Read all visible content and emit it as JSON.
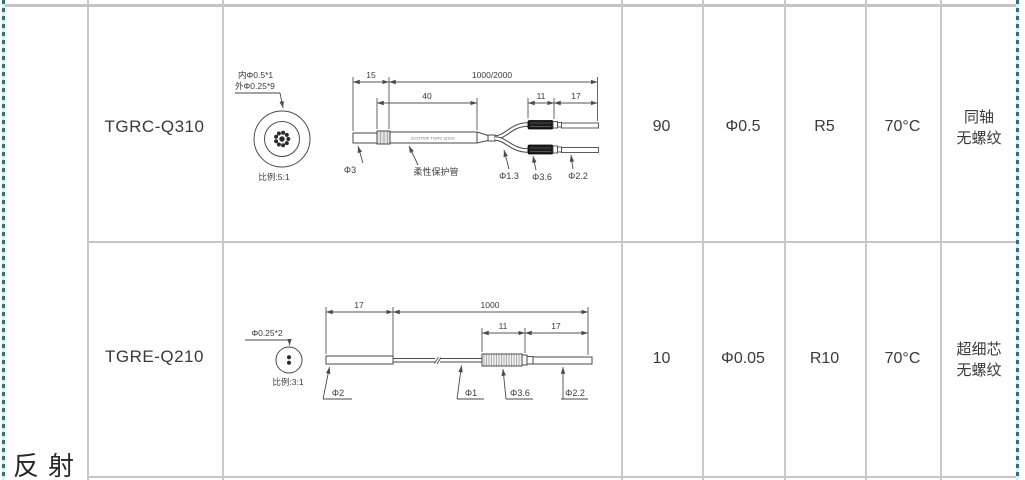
{
  "section": {
    "label": "反射"
  },
  "colors": {
    "marquee": "#2e6f80",
    "grid": "#c9c9c9",
    "ink": "#3c3c3c"
  },
  "rows": [
    {
      "model": "TGRC-Q310",
      "core_count": "90",
      "fiber_diameter": "Φ0.5",
      "bend_radius": "R5",
      "temperature": "70°C",
      "spec": [
        "同轴",
        "无螺纹"
      ],
      "diagram": {
        "callout_inner": "内Φ0.5*1",
        "callout_outer": "外Φ0.25*9",
        "scale": "比例:5:1",
        "dim_tip": "15",
        "dim_cable": "1000/2000",
        "dim_tube": "40",
        "dim_connector": "11",
        "dim_end": "17",
        "label_phi3": "Φ3",
        "label_tube": "柔性保护管",
        "label_phi13": "Φ1.3",
        "label_phi36": "Φ3.6",
        "label_phi22": "Φ2.2",
        "tube_marking": "ECOTER TGRC-Q310"
      }
    },
    {
      "model": "TGRE-Q210",
      "core_count": "10",
      "fiber_diameter": "Φ0.05",
      "bend_radius": "R10",
      "temperature": "70°C",
      "spec": [
        "超细芯",
        "无螺纹"
      ],
      "diagram": {
        "callout": "Φ0.25*2",
        "scale": "比例:3:1",
        "dim_tip": "17",
        "dim_cable": "1000",
        "dim_connector": "11",
        "dim_end": "17",
        "label_phi2": "Φ2",
        "label_phi1": "Φ1",
        "label_phi36": "Φ3.6",
        "label_phi22": "Φ2.2"
      }
    }
  ]
}
